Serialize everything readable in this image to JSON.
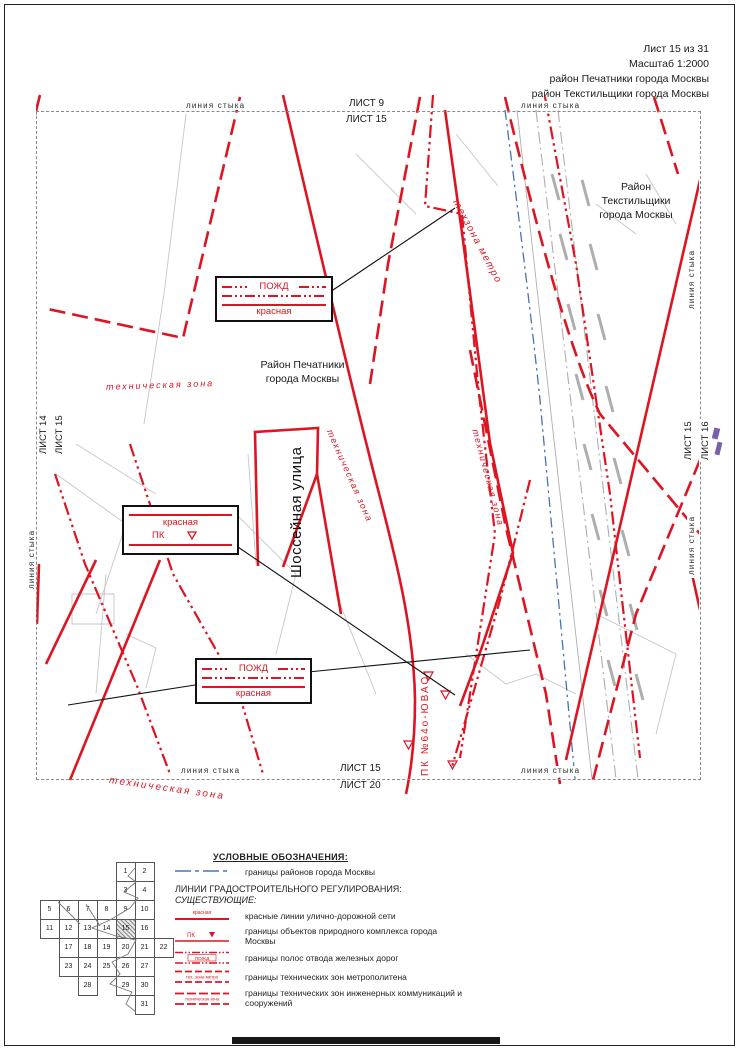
{
  "title_block": {
    "line1": "Лист 15 из 31",
    "line2": "Масштаб 1:2000",
    "line3": "район Печатники города Москвы",
    "line4": "район Текстильщики города Москвы"
  },
  "colors": {
    "red": "#dd1522",
    "blue": "#4a74ad",
    "gray": "#b5b5b5",
    "purple": "#7a5fae",
    "black": "#111111"
  },
  "map": {
    "edge_labels": {
      "seam_top_left": "линия стыка",
      "seam_top_right": "линия стыка",
      "sheet_top_above": "ЛИСТ 9",
      "sheet_top_below": "ЛИСТ 15",
      "sheet_left_outer": "ЛИСТ 14",
      "sheet_left_inner": "ЛИСТ 15",
      "seam_left": "линия стыка",
      "seam_right_top": "линия стыка",
      "sheet_right_inner": "ЛИСТ 15",
      "sheet_right_outer": "ЛИСТ 16",
      "seam_right_bottom": "линия стыка",
      "seam_bottom_left": "линия стыка",
      "seam_bottom_right": "линия стыка",
      "sheet_bottom_above": "ЛИСТ 15",
      "sheet_bottom_below": "ЛИСТ 20"
    },
    "labels": {
      "district_pechatniki": [
        "Район Печатники",
        "города Москвы"
      ],
      "district_tekstilshchiki": [
        "Район",
        "Текстильщики",
        "города Москвы"
      ],
      "street": "Шоссейная улица",
      "tech_zone_1": "техническая зона",
      "tech_zone_2": "техническая зона",
      "tech_zone_3": "техническая зона",
      "tech_zone_bottom": "техническая зона",
      "tech_zone_metro": "техзона метро",
      "pk_number": "ПК №64о-ЮВАО"
    },
    "callouts": {
      "pozhd_top": {
        "line1": "ПОЖД",
        "line2": "красная"
      },
      "krasnaya_pk": {
        "line1": "красная",
        "line2": "ПК"
      },
      "pozhd_bottom": {
        "line1": "ПОЖД",
        "line2": "красная"
      }
    }
  },
  "legend": {
    "title": "УСЛОВНЫЕ ОБОЗНАЧЕНИЯ:",
    "heading1": "ЛИНИИ ГРАДОСТРОИТЕЛЬНОГО РЕГУЛИРОВАНИЯ:",
    "heading2": "СУЩЕСТВУЮЩИЕ:",
    "items": [
      {
        "symbol": "district-boundary",
        "symbol_text": "",
        "label": "границы районов города Москвы"
      },
      {
        "symbol": "red-line",
        "symbol_text": "красная",
        "label": "красные линии улично-дорожной сети"
      },
      {
        "symbol": "pk",
        "symbol_text": "ПК",
        "label": "границы объектов природного комплекса города Москвы"
      },
      {
        "symbol": "pozhd",
        "symbol_text": "ПОЖД",
        "label": "границы полос отвода железных дорог"
      },
      {
        "symbol": "metro-zone",
        "symbol_text": "тех. зона метро",
        "label": "границы технических зон метрополитена"
      },
      {
        "symbol": "tech-zone",
        "symbol_text": "техническая зона",
        "label": "границы технических зон инженерных коммуникаций и сооружений"
      }
    ]
  },
  "sheet_index": {
    "current": "15",
    "cells": [
      {
        "n": "1",
        "c": 5,
        "r": 1
      },
      {
        "n": "2",
        "c": 6,
        "r": 1
      },
      {
        "n": "3",
        "c": 5,
        "r": 2
      },
      {
        "n": "4",
        "c": 6,
        "r": 2
      },
      {
        "n": "5",
        "c": 1,
        "r": 3
      },
      {
        "n": "6",
        "c": 2,
        "r": 3
      },
      {
        "n": "7",
        "c": 3,
        "r": 3
      },
      {
        "n": "8",
        "c": 4,
        "r": 3
      },
      {
        "n": "9",
        "c": 5,
        "r": 3
      },
      {
        "n": "10",
        "c": 6,
        "r": 3
      },
      {
        "n": "11",
        "c": 1,
        "r": 4
      },
      {
        "n": "12",
        "c": 2,
        "r": 4
      },
      {
        "n": "13",
        "c": 3,
        "r": 4
      },
      {
        "n": "14",
        "c": 4,
        "r": 4
      },
      {
        "n": "15",
        "c": 5,
        "r": 4
      },
      {
        "n": "16",
        "c": 6,
        "r": 4
      },
      {
        "n": "17",
        "c": 2,
        "r": 5
      },
      {
        "n": "18",
        "c": 3,
        "r": 5
      },
      {
        "n": "19",
        "c": 4,
        "r": 5
      },
      {
        "n": "20",
        "c": 5,
        "r": 5
      },
      {
        "n": "21",
        "c": 6,
        "r": 5
      },
      {
        "n": "22",
        "c": 7,
        "r": 5
      },
      {
        "n": "23",
        "c": 2,
        "r": 6
      },
      {
        "n": "24",
        "c": 3,
        "r": 6
      },
      {
        "n": "25",
        "c": 4,
        "r": 6
      },
      {
        "n": "26",
        "c": 5,
        "r": 6
      },
      {
        "n": "27",
        "c": 6,
        "r": 6
      },
      {
        "n": "28",
        "c": 3,
        "r": 7
      },
      {
        "n": "29",
        "c": 5,
        "r": 7
      },
      {
        "n": "30",
        "c": 6,
        "r": 7
      },
      {
        "n": "31",
        "c": 6,
        "r": 8
      }
    ]
  }
}
